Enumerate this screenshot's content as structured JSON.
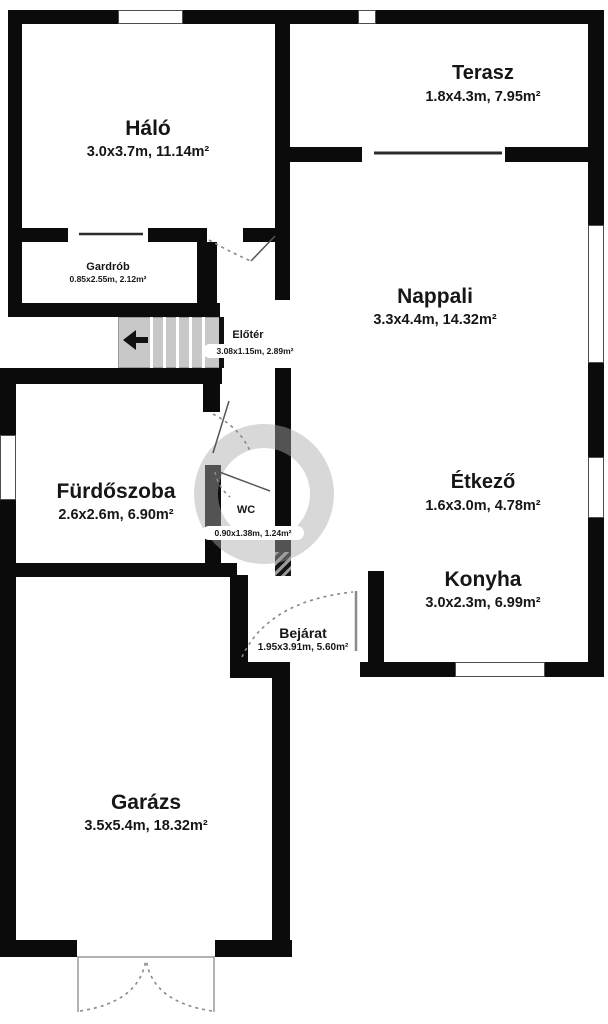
{
  "floorplan": {
    "rooms": {
      "halo": {
        "name": "Háló",
        "dims": "3.0x3.7m, 11.14m²"
      },
      "terasz": {
        "name": "Terasz",
        "dims": "1.8x4.3m, 7.95m²"
      },
      "gardrob": {
        "name": "Gardrób",
        "dims": "0.85x2.55m, 2.12m²"
      },
      "eloter": {
        "name": "Előtér",
        "dims": "3.08x1.15m, 2.89m²"
      },
      "nappali": {
        "name": "Nappali",
        "dims": "3.3x4.4m, 14.32m²"
      },
      "furdoszoba": {
        "name": "Fürdőszoba",
        "dims": "2.6x2.6m, 6.90m²"
      },
      "wc": {
        "name": "WC",
        "dims": "0.90x1.38m, 1.24m²"
      },
      "etkezo": {
        "name": "Étkező",
        "dims": "1.6x3.0m, 4.78m²"
      },
      "konyha": {
        "name": "Konyha",
        "dims": "3.0x2.3m, 6.99m²"
      },
      "bejarat": {
        "name": "Bejárat",
        "dims": "1.95x3.91m, 5.60m²"
      },
      "garazs": {
        "name": "Garázs",
        "dims": "3.5x5.4m, 18.32m²"
      }
    },
    "colors": {
      "wall": "#0b0b0b",
      "stairs": "#c8c8c8",
      "watermark": "#ababab"
    }
  }
}
